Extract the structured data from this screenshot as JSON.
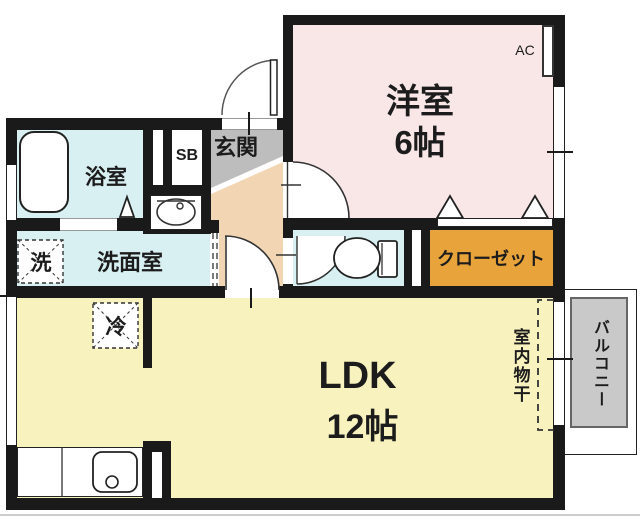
{
  "rooms": {
    "western": {
      "label": "洋室",
      "size": "6帖"
    },
    "ldk": {
      "label": "LDK",
      "size": "12帖"
    },
    "bath": {
      "label": "浴室"
    },
    "washroom": {
      "label": "洗面室"
    },
    "laundry": {
      "label": "洗"
    },
    "fridge": {
      "label": "冷"
    },
    "entrance": {
      "label": "玄関"
    },
    "shoebox": {
      "label": "SB"
    },
    "closet": {
      "label": "クローゼット"
    },
    "balcony": {
      "label": "バルコニー"
    },
    "indoor_drying": {
      "label": "室内物干"
    },
    "ac": {
      "label": "AC"
    }
  },
  "colors": {
    "wall": "#1a1a1a",
    "western_room": "#f9e7e7",
    "wet_rooms": "#d8f0f2",
    "ldk": "#f8f3be",
    "hallway": "#f2d6b3",
    "entrance": "#bdbdbd",
    "closet": "#e8a33b",
    "balcony": "#c9c9c9"
  }
}
